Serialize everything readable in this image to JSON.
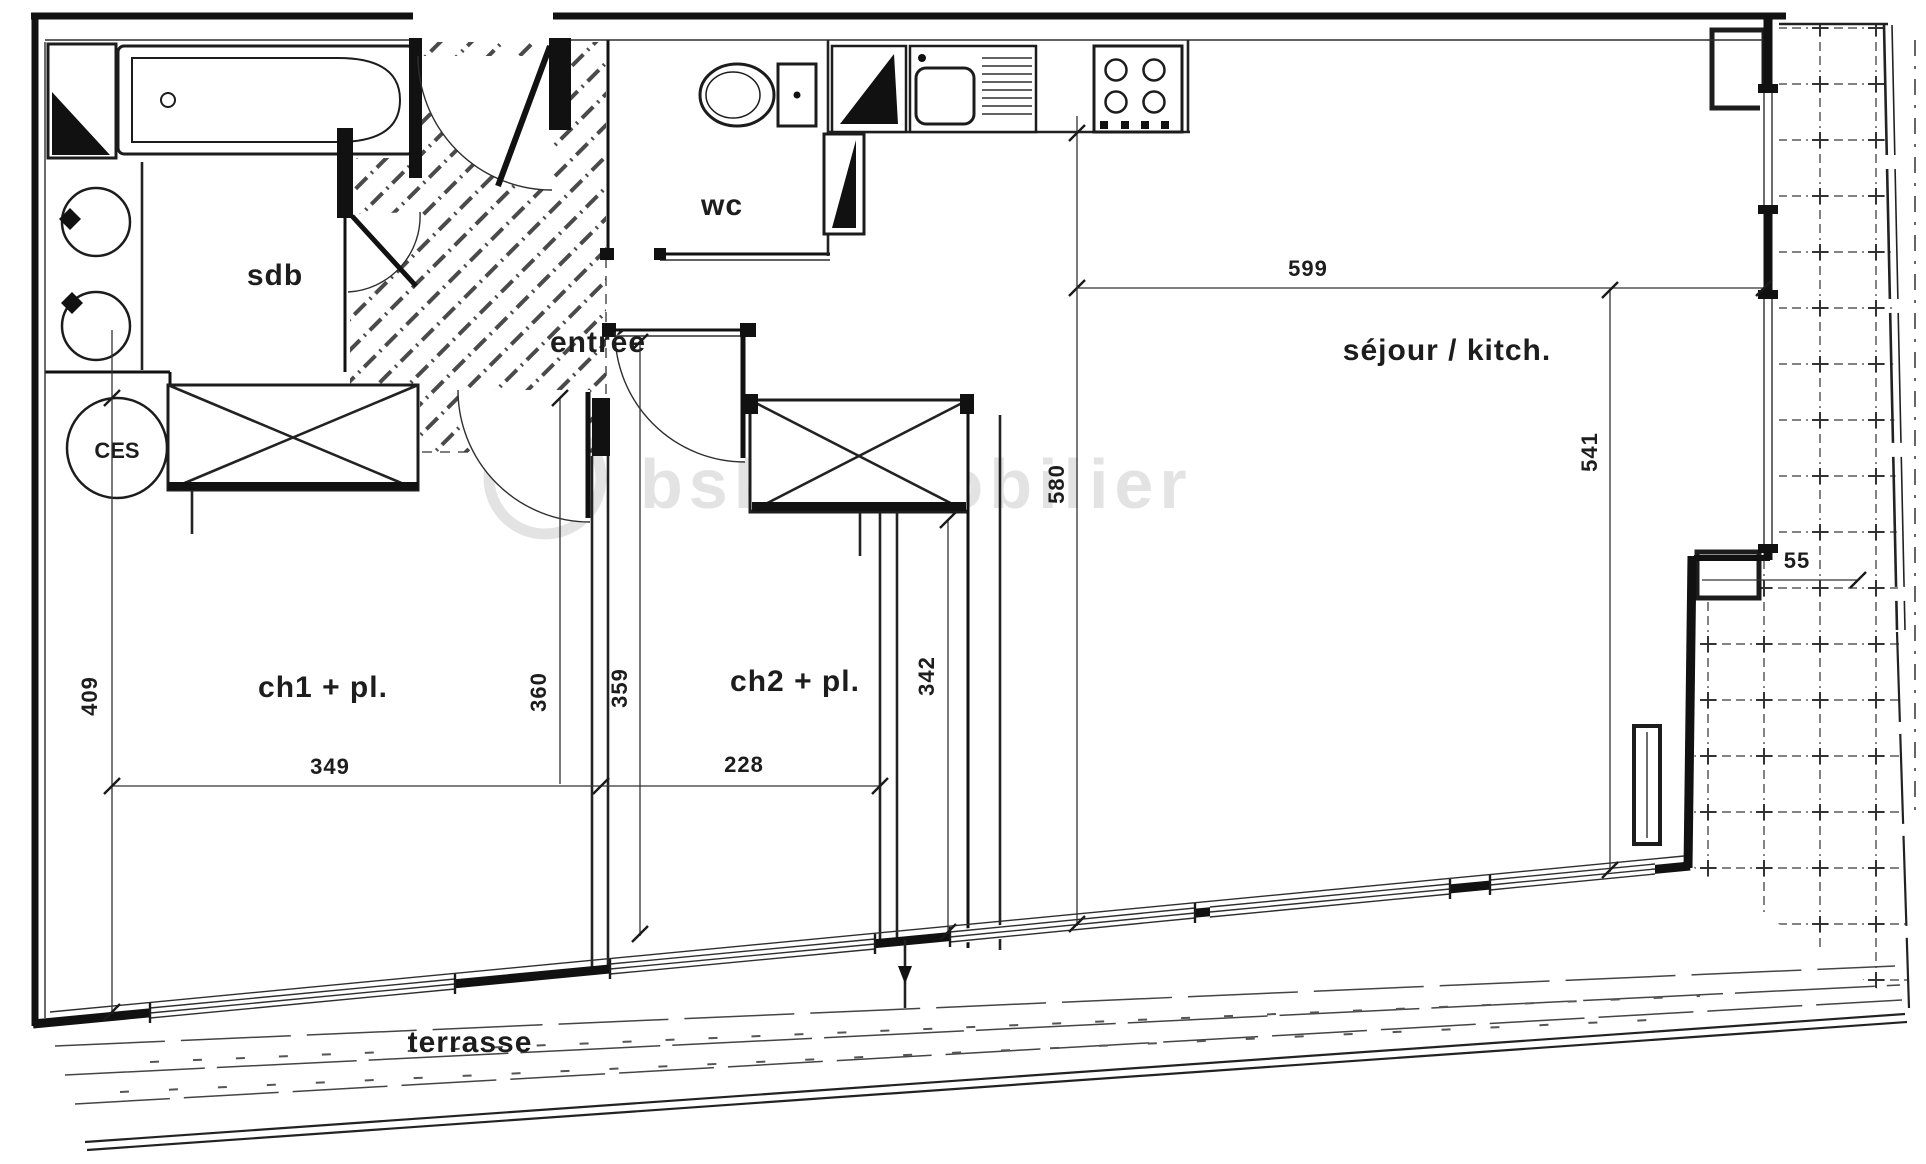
{
  "meta": {
    "title": "apartment floor plan (scanned)"
  },
  "colors": {
    "ink": "#1c1c1c",
    "thin_line": "#333333",
    "hatch": "#4a4a4a",
    "watermark": "#e3e3e3",
    "paper": "#ffffff"
  },
  "watermark": {
    "text": "bskimmobilier",
    "logo": "bskimmobilier-logo"
  },
  "rooms": {
    "sdb": {
      "label": "sdb"
    },
    "wc": {
      "label": "wc"
    },
    "entree": {
      "label": "entrée"
    },
    "sejour": {
      "label": "séjour / kitch."
    },
    "ch1": {
      "label": "ch1 + pl."
    },
    "ch2": {
      "label": "ch2 + pl."
    },
    "terrasse": {
      "label": "terrasse"
    },
    "ces": {
      "label": "CES"
    }
  },
  "dimensions": {
    "sejour_width": "599",
    "sejour_height": "541",
    "left_height": "580",
    "ch1_height": "409",
    "ch1_width": "349",
    "partition_left": "360",
    "partition_right": "359",
    "ch2_height": "342",
    "ch2_width": "228",
    "terrace_depth": "55"
  }
}
